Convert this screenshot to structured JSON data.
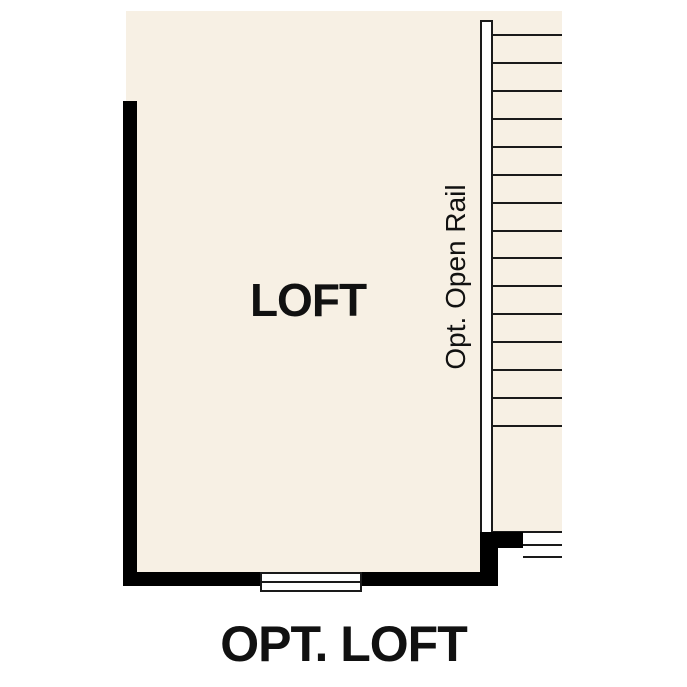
{
  "room": {
    "label": "LOFT"
  },
  "stairs": {
    "rail_label": "Opt. Open Rail",
    "upper_tread_count": 15,
    "upper_tread_start_y": 34,
    "upper_tread_spacing": 27.93,
    "lower_tread_count": 2,
    "lower_tread_start_y": 544,
    "lower_tread_spacing": 12
  },
  "caption": "OPT. LOFT",
  "colors": {
    "floor": "#F7F0E4",
    "wall": "#000000",
    "line": "#1A1A1A",
    "background": "#FFFFFF"
  }
}
